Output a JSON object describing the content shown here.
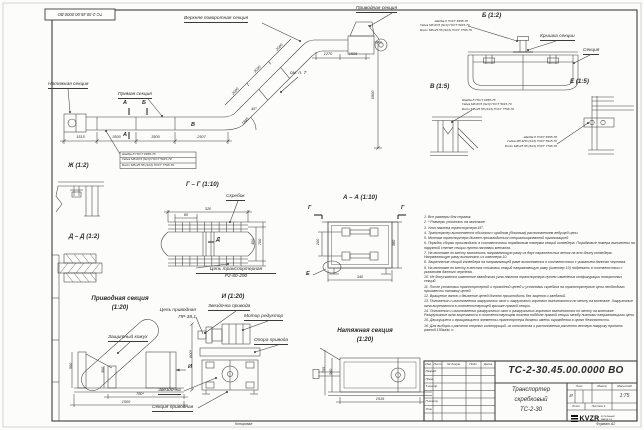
{
  "stamp": {
    "reversed_designation": "ТС-2-30.45.00.0000 ВО"
  },
  "main_view": {
    "labels": {
      "upper_turn_section": "Верхняя поворотная секция",
      "drive_section": "Приводная секция",
      "tension_section": "Натяжная секция",
      "straight_section": "Прямая секция",
      "see_note": "см. п. 7",
      "angle": "45°"
    },
    "marks": {
      "a_top": "А",
      "a_bottom": "А",
      "b": "Б",
      "v": "В"
    },
    "dims": {
      "d1515": "1515",
      "d3500a": "3500",
      "d3500b": "3500",
      "d2507": "2507",
      "i1845": "1845",
      "i2000a": "2000",
      "i3030": "3030",
      "i2000b": "2000",
      "t1270": "1270",
      "t1505": "1505",
      "h6900": "6900"
    }
  },
  "fasteners": {
    "washer": "Шайба 8 ГОСТ 6958-78",
    "nut": "Гайка М8-6Н3 (S13) ГОСТ 5915-70",
    "bolt": "Болт М8х25.58 (S13) ГОСТ 7798-70"
  },
  "view_b": {
    "title": "Б (1:2)",
    "cover_label": "Крышка секции",
    "section_label": "Секция"
  },
  "view_v": {
    "title": "В (1:5)"
  },
  "view_e": {
    "title": "Е (1:5)"
  },
  "view_zh": {
    "title": "Ж (1:2)"
  },
  "view_gg": {
    "title": "Г – Г (1:10)",
    "scraper_label": "Скребок",
    "chain_label1": "Цепь транспортерная",
    "chain_label2": "Р2-80-290",
    "mark_d": "Д",
    "dims": {
      "w320": "320",
      "p80": "80",
      "h700": "700",
      "h400": "400"
    }
  },
  "view_dd": {
    "title": "Д – Д (1:2)"
  },
  "view_aa": {
    "title": "А – А (1:10)",
    "mark_g_left": "Г",
    "mark_g_right": "Г",
    "mark_e": "Е",
    "dims": {
      "h200": "200",
      "h380": "380",
      "w340": "340"
    }
  },
  "view_drive": {
    "title": "Приводная секция",
    "scale": "(1:20)",
    "casing_label": "Защитный кожух",
    "mark_i": "И",
    "dims": {
      "w780": "780*",
      "w1500": "1500",
      "h560": "560",
      "h300": "300"
    }
  },
  "view_i": {
    "title": "И (1:20)",
    "sprocket_label": "Звездочка привода",
    "motor_label": "Мотор редуктор",
    "support_label": "Опора привода",
    "chain_label1": "Цепь приводная",
    "chain_label2": "ПР-38,1",
    "sprocket2_label": "Звездочка",
    "section_label": "Секция приводная",
    "dims": {
      "h800": "800*"
    }
  },
  "view_tension": {
    "title": "Натяжная секция",
    "scale": "(1:20)",
    "dims": {
      "w1515": "1515",
      "h560": "560",
      "h755": "755"
    }
  },
  "notes": [
    "1. Все размеры для справок.",
    "2. * Размеры уточнить на монтаже.",
    "3. Угол наклона транспортера 45°.",
    "4. Транспортер выполняется обычным с крайним (боковым) расположением ведущей цепи.",
    "5. Монтаж транспортера должен производиться специализированной организацией.",
    "6. Порядок сборки производить в соответствии порядковым номерам секций конвейера. Порядковые номера выполнены на наружной стенке секции путем наплавки металла.",
    "7. На монтаже по месту выполнить направляющую раму из двух параллельных веток на всю длину конвейера. Направляющую раму выполнить из швеллера 10.",
    "8. Закрепление секций конвейера на направляющей раме выполняется в соответствии с указанием данного чертежа.",
    "9. На монтаже по месту в местах стыковки секций направляющую раму (швеллер 10) подрезать в соответствии с указанием данного чертежа.",
    "10. Не допускается изменение заводского угла наклона транспортера путем изменения конфигурации поворотных секций.",
    "11. После установки транспортерной и приводной цепей и установки скребков на транспортерные цепи необходимо произвести натяжку цепей.",
    "12. Вращение валов и движение цепей должно происходить без зацепов и заеданий.",
    "13. Положения и изготовления загрузочных окон и загрузочных горловин выполняются по месту на монтаже. Загрузочные окна вырезаются в соответствующей крышке прямой секции.",
    "14. Положения и изготовления разгрузочных окон и разгрузочных горловин выполняются по месту на монтаже. Разгрузочные окна вырезаются в соответствующем нижнем поддоне прямой секции между нижними направляющими цепи.",
    "15. Движущиеся и вращающиеся элементы транспортера должны иметь ограждения в целях безопасности.",
    "16. Для выбора и расчета опорных конструкций, их количества и расположения расчетно-весовую нагрузку принять равной 150кг/м. п."
  ],
  "title_block": {
    "designation": "ТС-2-30.45.00.0000  ВО",
    "name1": "Транспортер",
    "name2": "скребковый",
    "name3": "ТС-2-30",
    "lit_header": "Лит.",
    "mass_header": "Масса",
    "scale_header": "Масштаб",
    "lit_value": "И",
    "scale_value": "1:75",
    "sheet_label": "Лист",
    "sheets_label": "Листов 1",
    "logo": "KVZR",
    "logo_sub1": "КОТЕЛЬНЫЙ",
    "logo_sub2": "ЗАВОД РФ",
    "col_izm": "Изм.",
    "col_list": "Лист",
    "col_doc": "№ докум.",
    "col_sign": "Подп.",
    "col_date": "Дата",
    "row_razrab": "Разраб.",
    "row_prov": "Пров.",
    "row_tkontr": "Т.контр.",
    "row_nkontr": "Н.контр.",
    "row_utv": "Утв.",
    "copied": "Копировал",
    "format": "Формат А2"
  }
}
